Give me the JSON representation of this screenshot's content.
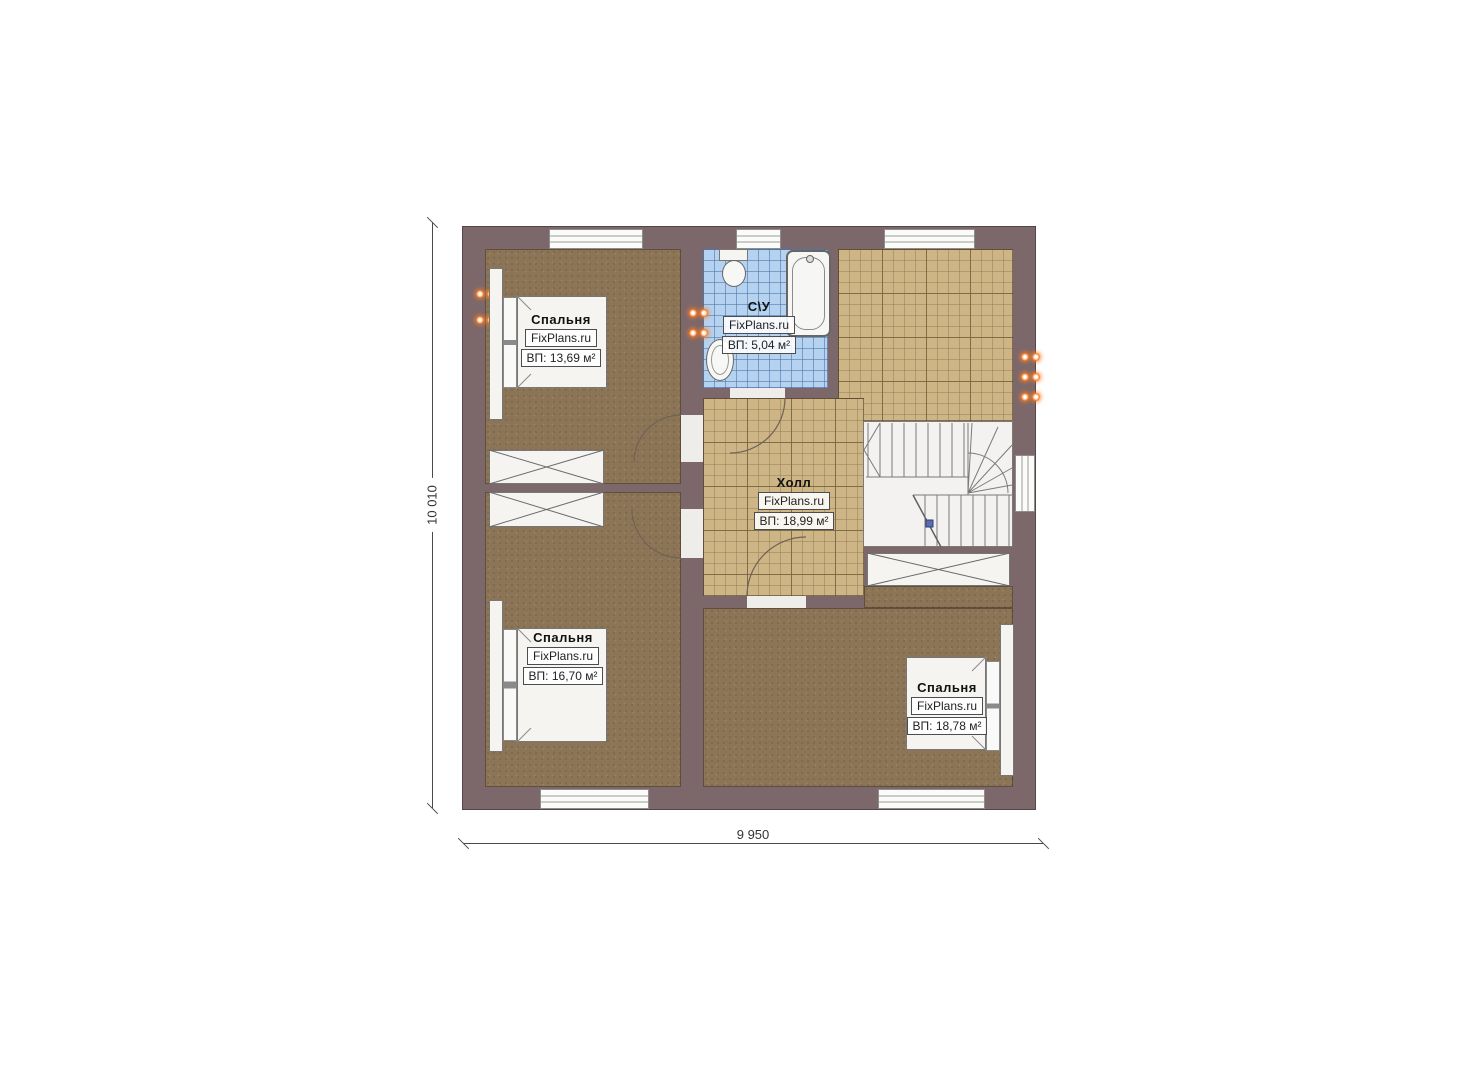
{
  "plan": {
    "watermark": "FixPlans.ru",
    "colors": {
      "wall": "#7c686a",
      "carpet": "#8c7456",
      "hall_tile": "#cdb586",
      "bath_tile": "#b5d2f0",
      "socket_accent": "#f47920",
      "stair_marker": "#5a6fae"
    },
    "dimensions": {
      "vertical": "10 010",
      "horizontal": "9 950"
    },
    "rooms": [
      {
        "name": "Спальня",
        "watermark": "FixPlans.ru",
        "area": "ВП: 13,69 м²"
      },
      {
        "name": "С\\У",
        "watermark": "FixPlans.ru",
        "area": "ВП: 5,04 м²"
      },
      {
        "name": "Холл",
        "watermark": "FixPlans.ru",
        "area": "ВП: 18,99 м²"
      },
      {
        "name": "Спальня",
        "watermark": "FixPlans.ru",
        "area": "ВП: 16,70 м²"
      },
      {
        "name": "Спальня",
        "watermark": "FixPlans.ru",
        "area": "ВП: 18,78 м²"
      }
    ]
  }
}
